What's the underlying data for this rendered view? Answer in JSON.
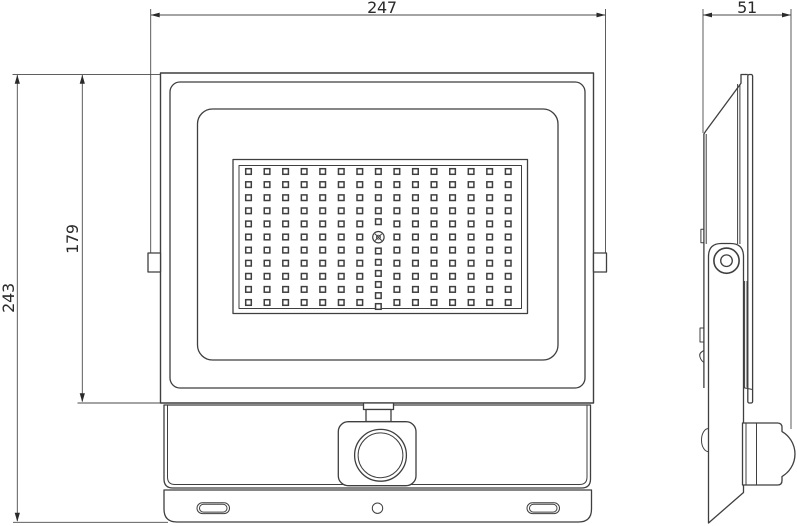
{
  "drawing": {
    "colors": {
      "background": "#ffffff",
      "line": "#3f3f3f",
      "dim_line": "#4a4a4a",
      "text": "#2a2a2a"
    },
    "dimensions": {
      "front_width": {
        "label": "247"
      },
      "body_height": {
        "label": "179"
      },
      "total_height": {
        "label": "243"
      },
      "side_depth": {
        "label": "51"
      }
    },
    "front_view": {
      "led_grid": {
        "columns": 15,
        "rows": 11,
        "x_start": 248.5,
        "x_step": 18.55,
        "y_start": 171.5,
        "y_step": 13.1,
        "cell_size": 5.6,
        "center_column_index": 7,
        "center_above_ys": [
          171.5,
          184.6,
          197.7,
          210.8,
          221.7
        ],
        "center_below_ys": [
          251.0,
          262.3,
          273.4,
          284.5,
          295.6,
          306.5
        ]
      }
    }
  }
}
